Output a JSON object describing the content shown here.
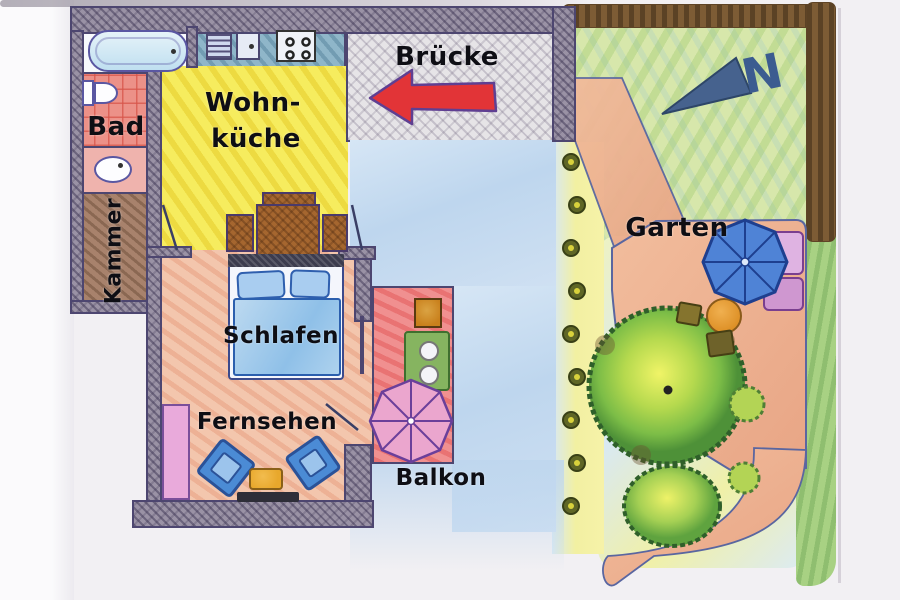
{
  "document": {
    "kind": "hand-drawn apartment floor plan with garden",
    "language": "de"
  },
  "labels": {
    "bridge": "Brücke",
    "bathroom": "Bad",
    "storage_room": "Kammer",
    "living_kitchen_line1": "Wohn-",
    "living_kitchen_line2": "küche",
    "sleeping": "Schlafen",
    "tv": "Fernsehen",
    "balcony": "Balkon",
    "garden": "Garten",
    "compass_north": "N"
  },
  "icons": [
    "bathtub-icon",
    "toilet-icon",
    "washbasin-icon",
    "kitchen-sink-icon",
    "stove-icon",
    "dining-table-icon",
    "chair-icon",
    "bed-icon",
    "pillow-icon",
    "blanket-icon",
    "wardrobe-icon",
    "armchair-icon",
    "coffee-table-icon",
    "tv-icon",
    "plant-pot-icon",
    "balcony-table-icon",
    "parasol-icon",
    "garden-bench-icon",
    "garden-table-icon",
    "stool-icon",
    "tree-icon",
    "bush-icon",
    "flower-icon",
    "hedge-icon",
    "north-arrow-icon",
    "entry-arrow-icon"
  ],
  "colors": {
    "wall": "#9a92a5",
    "outline": "#4d4670",
    "bathroom_tiles": "#ec9188",
    "living_kitchen": "#f6ec5e",
    "bedroom_floor": "#f3c6ad",
    "balcony_floor": "#f09090",
    "terrace": "#c8dcf0",
    "bridge_floor": "#e6e4e7",
    "garden_lawn": "#d7e7ab",
    "garden_path": "#eeb292",
    "hedge": "#7d5c35",
    "tree": "#7cbd47",
    "north_arrow": "#46628e",
    "entry_arrow": "#e23437",
    "bed_blanket": "#8fc0e8",
    "armchair": "#4b8bd5",
    "balcony_parasol": "#eba6ce",
    "garden_parasol": "#4f83d6"
  }
}
